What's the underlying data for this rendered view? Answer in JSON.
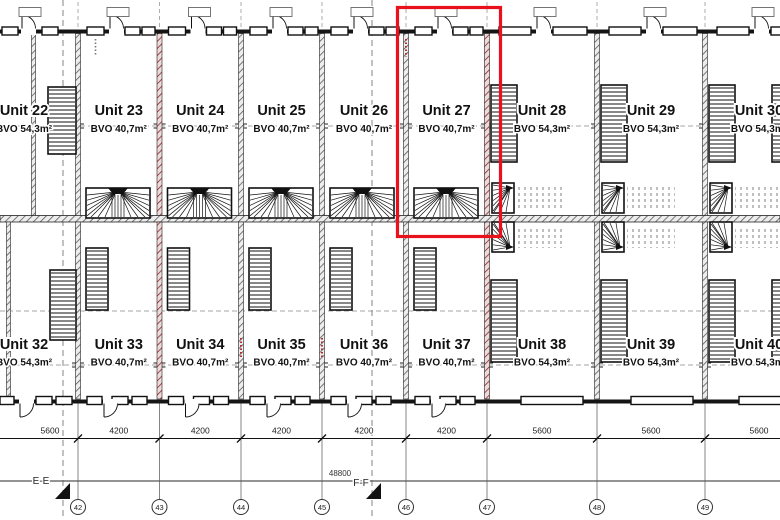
{
  "plan": {
    "title": "floor-plan",
    "highlight_color": "#e8111c",
    "highlighted_unit": "Unit 27",
    "units_top": [
      {
        "name": "Unit 22",
        "area": "BVO 54,3m²"
      },
      {
        "name": "Unit 23",
        "area": "BVO 40,7m²"
      },
      {
        "name": "Unit 24",
        "area": "BVO 40,7m²"
      },
      {
        "name": "Unit 25",
        "area": "BVO 40,7m²"
      },
      {
        "name": "Unit 26",
        "area": "BVO 40,7m²"
      },
      {
        "name": "Unit 27",
        "area": "BVO 40,7m²"
      },
      {
        "name": "Unit 28",
        "area": "BVO 54,3m²"
      },
      {
        "name": "Unit 29",
        "area": "BVO 54,3m²"
      },
      {
        "name": "Unit 30",
        "area": "BVO 54,3m²"
      }
    ],
    "units_bottom": [
      {
        "name": "Unit 32",
        "area": "BVO 54,3m²"
      },
      {
        "name": "Unit 33",
        "area": "BVO 40,7m²"
      },
      {
        "name": "Unit 34",
        "area": "BVO 40,7m²"
      },
      {
        "name": "Unit 35",
        "area": "BVO 40,7m²"
      },
      {
        "name": "Unit 36",
        "area": "BVO 40,7m²"
      },
      {
        "name": "Unit 37",
        "area": "BVO 40,7m²"
      },
      {
        "name": "Unit 38",
        "area": "BVO 54,3m²"
      },
      {
        "name": "Unit 39",
        "area": "BVO 54,3m²"
      },
      {
        "name": "Unit 40",
        "area": "BVO 54,3m²"
      }
    ]
  },
  "dimensions": {
    "segments": [
      "5600",
      "4200",
      "4200",
      "4200",
      "4200",
      "4200",
      "5600",
      "5600",
      "5600"
    ],
    "total": "48800"
  },
  "grid_bubbles": [
    "42",
    "43",
    "44",
    "45",
    "46",
    "47",
    "48",
    "49"
  ],
  "sections": {
    "e": "E-E",
    "f": "F-F"
  }
}
